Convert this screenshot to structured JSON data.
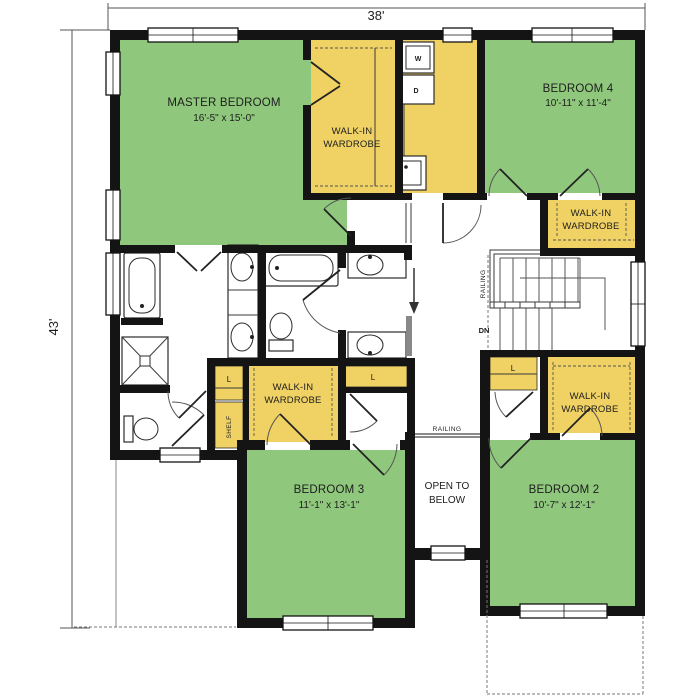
{
  "dimensions": {
    "width_label": "38'",
    "height_label": "43'"
  },
  "rooms": {
    "master_bedroom": {
      "name": "MASTER BEDROOM",
      "size": "16'-5\" x 15'-0\""
    },
    "bedroom_4": {
      "name": "BEDROOM 4",
      "size": "10'-11\" x 11'-4\""
    },
    "bedroom_3": {
      "name": "BEDROOM 3",
      "size": "11'-1\" x 13'-1\""
    },
    "bedroom_2": {
      "name": "BEDROOM 2",
      "size": "10'-7\" x 12'-1\""
    },
    "open_to_below": {
      "line1": "OPEN TO",
      "line2": "BELOW"
    },
    "walk_in_wardrobe": {
      "line1": "WALK-IN",
      "line2": "WARDROBE"
    }
  },
  "labels": {
    "railing": "RAILING",
    "down": "DN",
    "linen": "L",
    "shelf": "SHELF",
    "washer": "W",
    "dryer": "D"
  },
  "colors": {
    "green": "#8fc87d",
    "yellow": "#f0d164",
    "wall": "#141414"
  }
}
